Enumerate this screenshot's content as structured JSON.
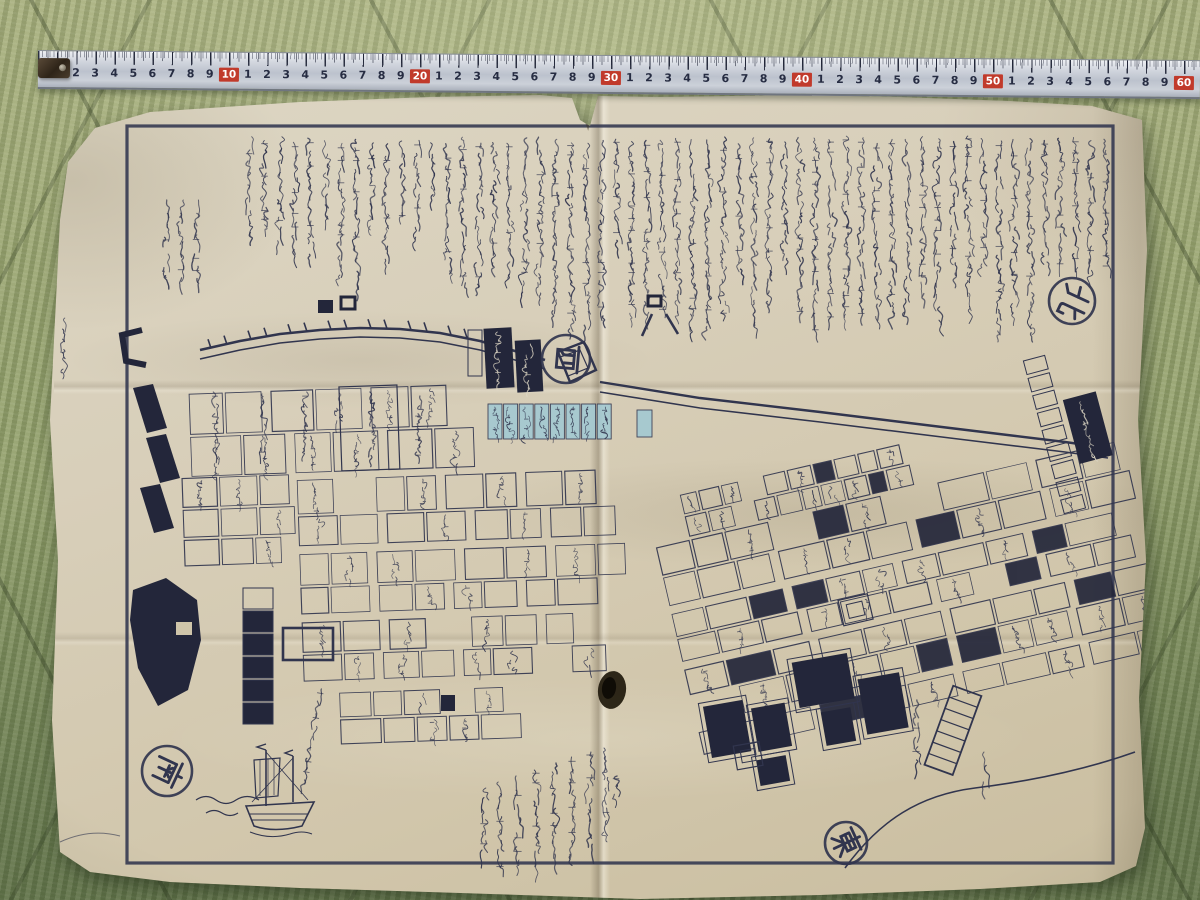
{
  "ruler": {
    "minor_labels": [
      "1",
      "2",
      "3",
      "4",
      "5",
      "6",
      "7",
      "8",
      "9"
    ],
    "major_labels": [
      "10",
      "20",
      "30",
      "40",
      "50",
      "60"
    ],
    "colors": {
      "tape": "#cdd2da",
      "badge": "#c13a2b",
      "badge_text": "#ffffff",
      "digits": "#262c42"
    }
  },
  "map": {
    "compass": {
      "west": "西",
      "north": "北",
      "east": "東",
      "south": "南"
    },
    "legend_lines": [
      "白ノ分 七日",
      "浅黄分 九日",
      "黄分 十日"
    ],
    "place_labels": {
      "ryogoku_bridge": "両国橋",
      "honjo": "本所",
      "relief_huts": "御救小屋場",
      "ryogoku_hirokoji": "両国広小路",
      "sakuma_cho": "佐久間町",
      "gate": "御門",
      "bishu": "尾州",
      "matsudaira": "松平"
    },
    "colors": {
      "ink": "#31354e",
      "paper": "#d6cdb6",
      "highlight": "#a3c9d2",
      "black_fill": "#23263a"
    }
  }
}
